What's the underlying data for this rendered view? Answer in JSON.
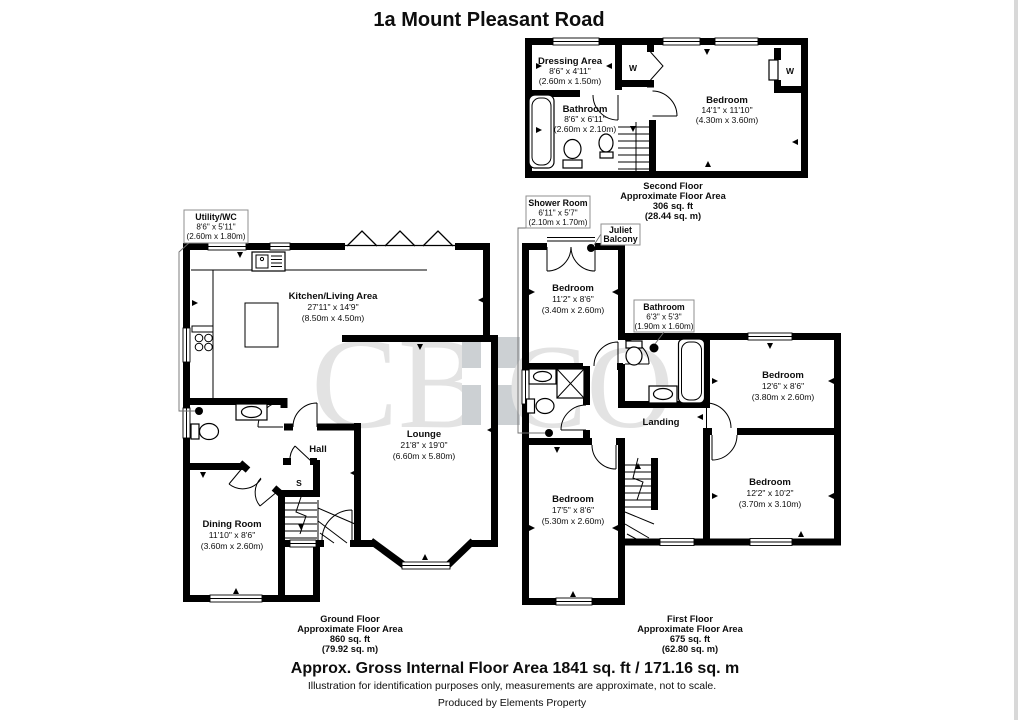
{
  "title": "1a Mount Pleasant Road",
  "watermark": {
    "left": "CB",
    "right": "CO"
  },
  "ground_floor": {
    "label": [
      "Ground Floor",
      "Approximate Floor Area",
      "860 sq. ft",
      "(79.92 sq. m)"
    ],
    "rooms": {
      "utility_wc": {
        "name": "Utility/WC",
        "imperial": "8'6\" x 5'11\"",
        "metric": "(2.60m x 1.80m)"
      },
      "kitchen_living": {
        "name": "Kitchen/Living Area",
        "imperial": "27'11\" x 14'9\"",
        "metric": "(8.50m x 4.50m)"
      },
      "lounge": {
        "name": "Lounge",
        "imperial": "21'8\" x 19'0\"",
        "metric": "(6.60m x 5.80m)"
      },
      "hall": {
        "name": "Hall"
      },
      "store": {
        "name": "S"
      },
      "dining": {
        "name": "Dining Room",
        "imperial": "11'10\" x 8'6\"",
        "metric": "(3.60m x 2.60m)"
      }
    }
  },
  "first_floor": {
    "label": [
      "First Floor",
      "Approximate Floor Area",
      "675 sq. ft",
      "(62.80 sq. m)"
    ],
    "rooms": {
      "shower_room": {
        "name": "Shower Room",
        "imperial": "6'11\" x 5'7\"",
        "metric": "(2.10m x 1.70m)"
      },
      "juliet": {
        "line1": "Juliet",
        "line2": "Balcony"
      },
      "bedroom_front": {
        "name": "Bedroom",
        "imperial": "11'2\" x 8'6\"",
        "metric": "(3.40m x 2.60m)"
      },
      "bathroom": {
        "name": "Bathroom",
        "imperial": "6'3\" x 5'3\"",
        "metric": "(1.90m x 1.60m)"
      },
      "bedroom_mid": {
        "name": "Bedroom",
        "imperial": "12'6\" x 8'6\"",
        "metric": "(3.80m x 2.60m)"
      },
      "bedroom_rear": {
        "name": "Bedroom",
        "imperial": "12'2\" x 10'2\"",
        "metric": "(3.70m x 3.10m)"
      },
      "bedroom_left": {
        "name": "Bedroom",
        "imperial": "17'5\" x 8'6\"",
        "metric": "(5.30m x 2.60m)"
      },
      "landing": {
        "name": "Landing"
      }
    }
  },
  "second_floor": {
    "label": [
      "Second Floor",
      "Approximate Floor Area",
      "306 sq. ft",
      "(28.44 sq. m)"
    ],
    "rooms": {
      "dressing": {
        "name": "Dressing Area",
        "imperial": "8'6\" x 4'11\"",
        "metric": "(2.60m x 1.50m)"
      },
      "bathroom": {
        "name": "Bathroom",
        "imperial": "8'6\" x 6'11\"",
        "metric": "(2.60m x 2.10m)"
      },
      "bedroom": {
        "name": "Bedroom",
        "imperial": "14'1\" x 11'10\"",
        "metric": "(4.30m x 3.60m)"
      },
      "wardrobe": {
        "name": "W"
      }
    }
  },
  "footer": {
    "total": "Approx. Gross Internal Floor Area 1841 sq. ft / 171.16 sq. m",
    "disclaimer": "Illustration for identification purposes only, measurements are approximate, not to scale.",
    "credit": "Produced by Elements Property"
  }
}
